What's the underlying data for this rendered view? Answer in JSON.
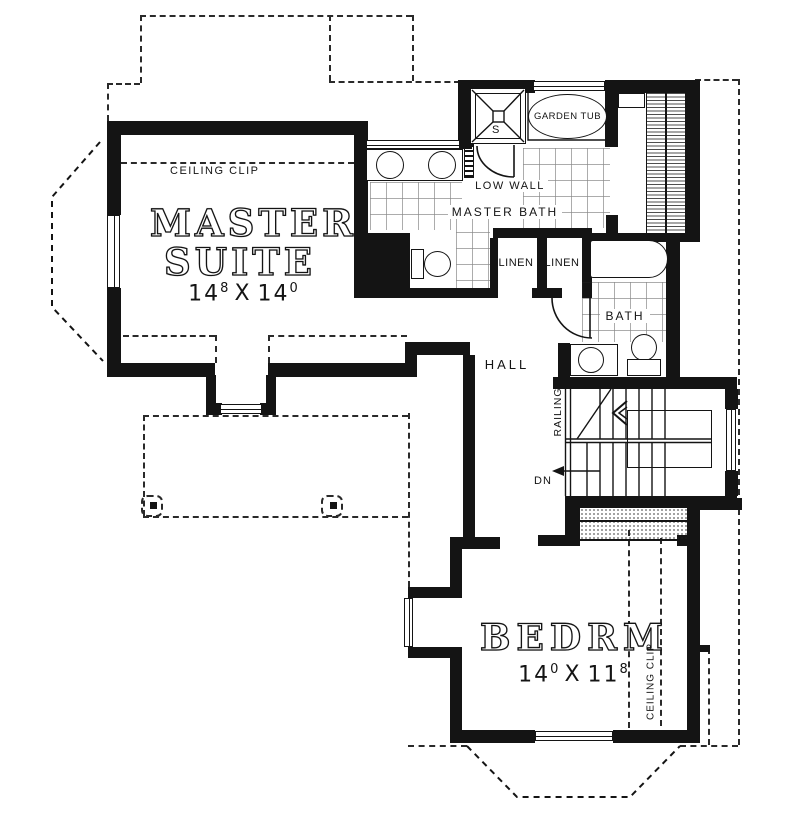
{
  "colors": {
    "ink": "#141414",
    "bg": "#ffffff",
    "grid": "#8a8a8a"
  },
  "rooms": {
    "master_suite": {
      "title_line1": "MASTER",
      "title_line2": "SUITE",
      "dim_w": "14",
      "dim_w_sup": "8",
      "dim_sep": "X",
      "dim_h": "14",
      "dim_h_sup": "0",
      "ceiling_note": "CEILING CLIP"
    },
    "master_bath": {
      "label": "MASTER BATH",
      "garden_tub_label": "GARDEN TUB",
      "low_wall_label": "LOW WALL",
      "shower_label": "S"
    },
    "linen_closets": {
      "left_label": "LINEN",
      "right_label": "LINEN"
    },
    "hall_bath": {
      "label": "BATH"
    },
    "hall": {
      "label": "HALL"
    },
    "stairs": {
      "railing_label": "RAILING",
      "direction_label": "DN"
    },
    "bedroom": {
      "title": "BEDRM",
      "dim_w": "14",
      "dim_w_sup": "0",
      "dim_sep": "X",
      "dim_h": "11",
      "dim_h_sup": "8",
      "ceiling_note": "CEILING CLIP"
    }
  }
}
